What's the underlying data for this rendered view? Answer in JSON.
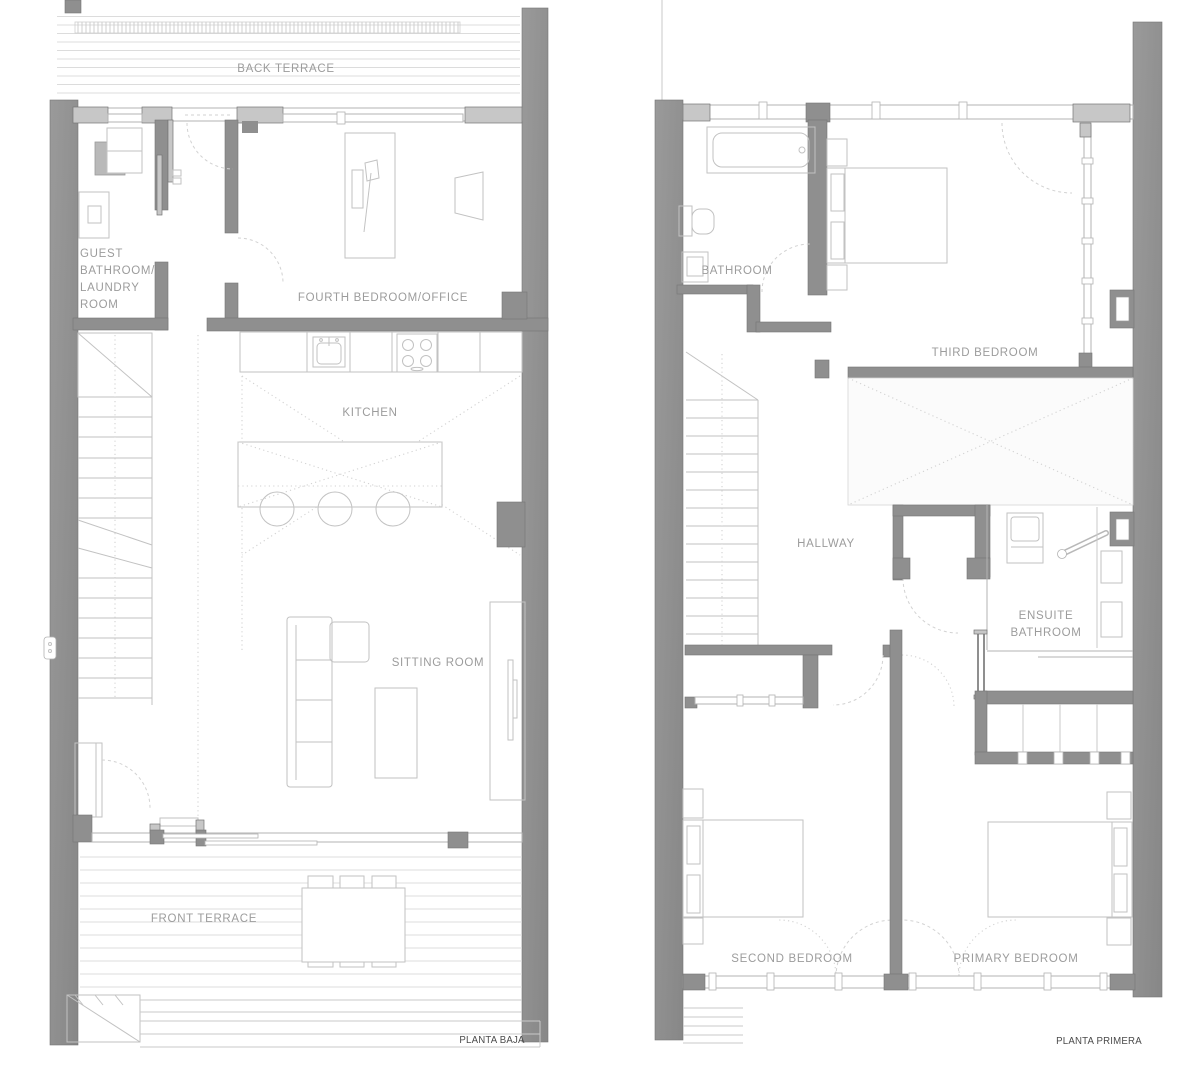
{
  "drawing_title": "Two storey house floor plans",
  "colors": {
    "wall": "#8f8f8f",
    "wall-edge": "#757575",
    "sill": "#c7c7c7",
    "band": "#b3b3b3",
    "line": "#c9c9c9",
    "furniture": "#c2c2c2",
    "deck": "#dcdcdc",
    "dash": "#d2d2d2",
    "label": "#9c9c9c",
    "caption": "#4b4b4b"
  },
  "ground_floor": {
    "caption": "PLANTA BAJA",
    "rooms": {
      "back_terrace": "BACK TERRACE",
      "guest_bath_lines": [
        "GUEST",
        "BATHROOM/",
        "LAUNDRY",
        "ROOM"
      ],
      "fourth_bedroom": "FOURTH BEDROOM/OFFICE",
      "kitchen": "KITCHEN",
      "sitting_room": "SITTING ROOM",
      "front_terrace": "FRONT TERRACE"
    }
  },
  "first_floor": {
    "caption": "PLANTA PRIMERA",
    "rooms": {
      "bathroom": "BATHROOM",
      "third_bedroom": "THIRD BEDROOM",
      "hallway": "HALLWAY",
      "ensuite_lines": [
        "ENSUITE",
        "BATHROOM"
      ],
      "second_bedroom": "SECOND BEDROOM",
      "primary_bedroom": "PRIMARY BEDROOM"
    }
  }
}
